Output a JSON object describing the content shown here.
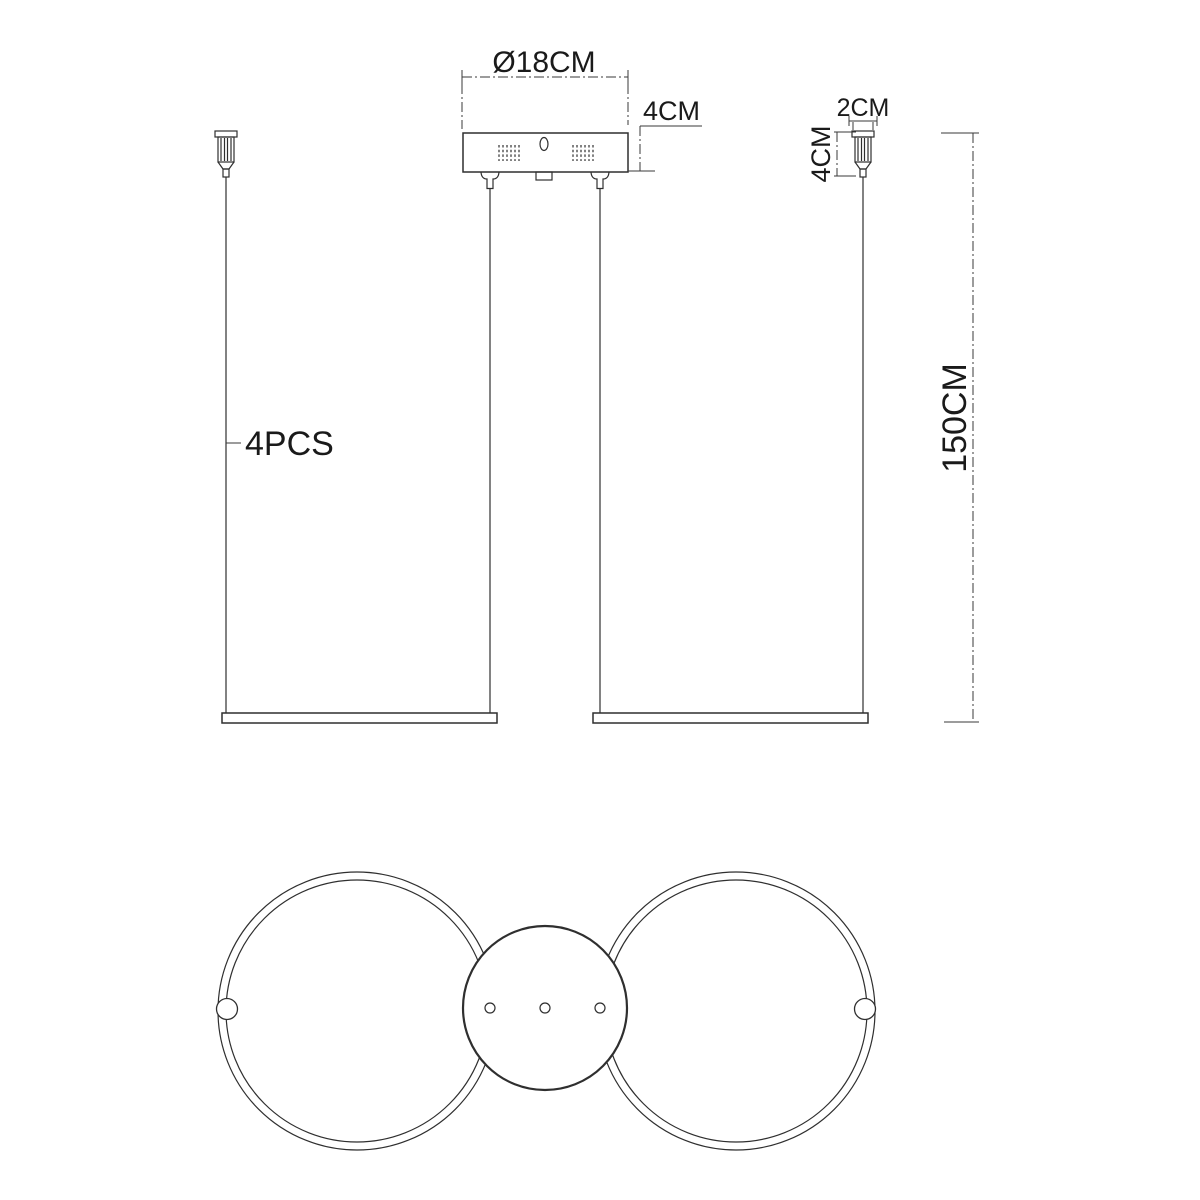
{
  "colors": {
    "background": "#ffffff",
    "line": "#2f2f2f",
    "dimension_line": "#3a3a3a",
    "text": "#1a1a1a"
  },
  "side_view": {
    "canopy_diameter_label": "Ø18CM",
    "canopy_height_label": "4CM",
    "gripper_width_label": "2CM",
    "gripper_height_label": "4CM",
    "suspension_length_label": "150CM",
    "gripper_quantity_label": "4PCS"
  }
}
